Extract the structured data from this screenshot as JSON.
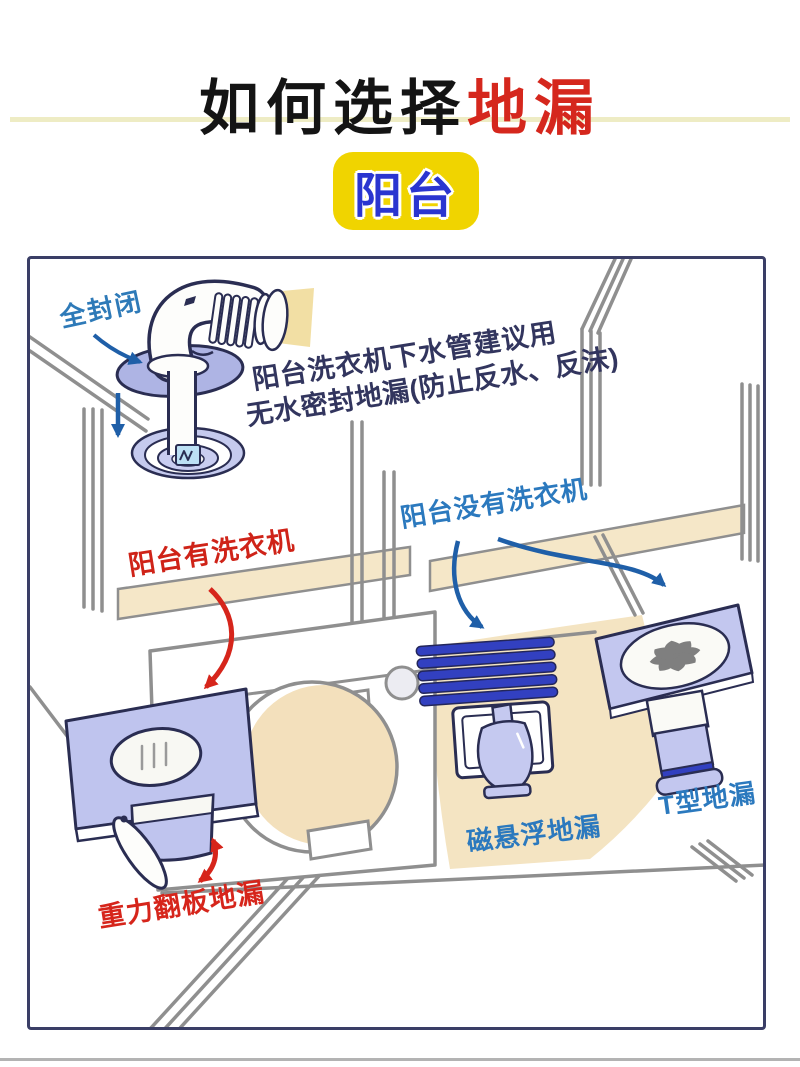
{
  "title": {
    "prefix": "如何选择",
    "highlight": "地漏"
  },
  "badge_label": "阳台",
  "diagram": {
    "seal_label": "全封闭",
    "advice_line1": "阳台洗衣机下水管建议用",
    "advice_line2": "无水密封地漏(防止反水、反沫)",
    "with_washer_label": "阳台有洗衣机",
    "without_washer_label": "阳台没有洗衣机",
    "gravity_drain_label": "重力翻板地漏",
    "maglev_drain_label": "磁悬浮地漏",
    "t_drain_label": "T型地漏"
  },
  "colors": {
    "title_highlight": "#D5271D",
    "badge_bg": "#F0D400",
    "badge_text": "#2A35D0",
    "red_label": "#D6251B",
    "blue_label": "#2B79BE",
    "advice_text": "#32355E",
    "arrow_blue": "#1F5FA8",
    "drain_lavender": "#BFC4EE",
    "slat_blue": "#3240C0",
    "floor_beige": "#F4E4C2"
  }
}
